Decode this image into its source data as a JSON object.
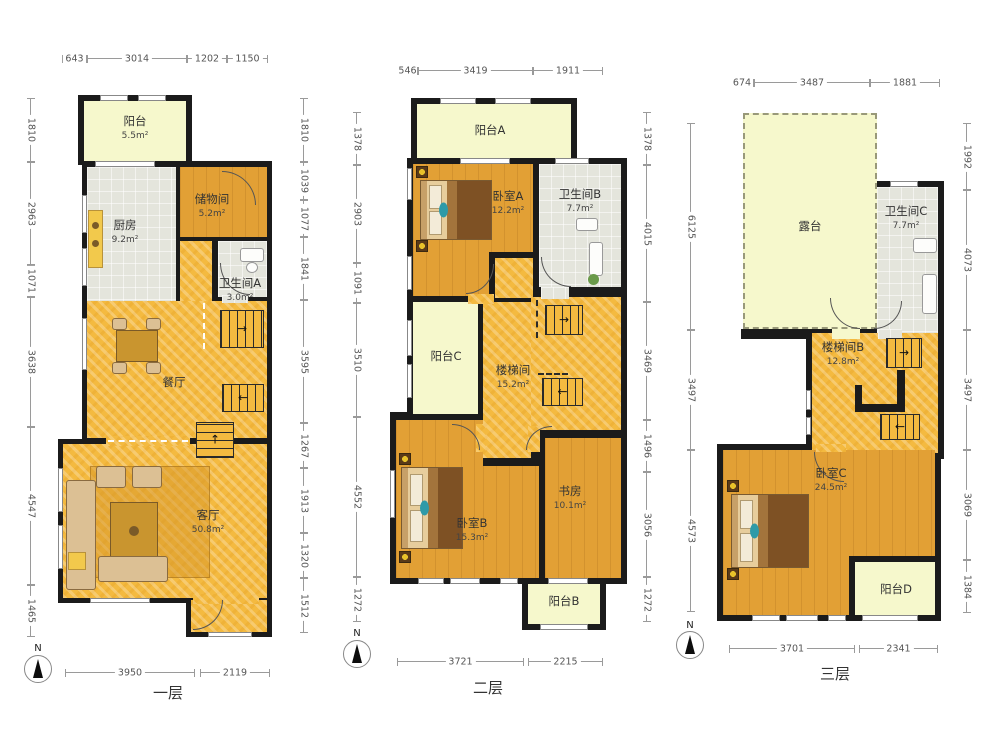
{
  "compass": {
    "letter": "N"
  },
  "icons": {
    "arrow_right": "→",
    "arrow_left": "←",
    "arrow_up": "↑"
  },
  "colors": {
    "wall": "#1b1b1b",
    "balcony": "#f6f8cc",
    "tile": "#e4e5dc",
    "wood": "#e2a035",
    "golden": "#f4ba40"
  },
  "floors": [
    {
      "label": "一层",
      "dims_top": [
        "643",
        "3014",
        "1202",
        "1150"
      ],
      "dims_bottom": [
        "3950",
        "2119"
      ],
      "dims_left": [
        "1810",
        "2963",
        "1071",
        "3638",
        "4547",
        "1465"
      ],
      "dims_right": [
        "1810",
        "1039",
        "1077",
        "1841",
        "3595",
        "1267",
        "1913",
        "1320",
        "1512"
      ],
      "rooms": {
        "balcony": {
          "name": "阳台",
          "area": "5.5m²"
        },
        "kitchen": {
          "name": "厨房",
          "area": "9.2m²"
        },
        "storage": {
          "name": "储物间",
          "area": "5.2m²"
        },
        "bath_a": {
          "name": "卫生间A",
          "area": "3.0m²"
        },
        "dining": {
          "name": "餐厅",
          "area": ""
        },
        "living": {
          "name": "客厅",
          "area": "50.8m²"
        }
      }
    },
    {
      "label": "二层",
      "dims_top": [
        "546",
        "3419",
        "1911"
      ],
      "dims_bottom": [
        "3721",
        "2215"
      ],
      "dims_left": [
        "1378",
        "2903",
        "1091",
        "3510",
        "4552",
        "1272"
      ],
      "dims_right": [
        "1378",
        "4015",
        "3469",
        "1496",
        "3056",
        "1272"
      ],
      "rooms": {
        "balcony_a": {
          "name": "阳台A",
          "area": ""
        },
        "bedroom_a": {
          "name": "卧室A",
          "area": "12.2m²"
        },
        "bath_b": {
          "name": "卫生间B",
          "area": "7.7m²"
        },
        "balcony_c": {
          "name": "阳台C",
          "area": ""
        },
        "stairwell": {
          "name": "楼梯间",
          "area": "15.2m²"
        },
        "bedroom_b": {
          "name": "卧室B",
          "area": "15.3m²"
        },
        "study": {
          "name": "书房",
          "area": "10.1m²"
        },
        "balcony_b": {
          "name": "阳台B",
          "area": ""
        }
      }
    },
    {
      "label": "三层",
      "dims_top": [
        "674",
        "3487",
        "1881"
      ],
      "dims_bottom": [
        "3701",
        "2341"
      ],
      "dims_left": [
        "6125",
        "3497",
        "4573"
      ],
      "dims_right": [
        "1992",
        "4073",
        "3497",
        "3069",
        "1384"
      ],
      "rooms": {
        "terrace": {
          "name": "露台",
          "area": ""
        },
        "bath_c": {
          "name": "卫生间C",
          "area": "7.7m²"
        },
        "stairwell_b": {
          "name": "楼梯间B",
          "area": "12.8m²"
        },
        "bedroom_c": {
          "name": "卧室C",
          "area": "24.5m²"
        },
        "balcony_d": {
          "name": "阳台D",
          "area": ""
        }
      }
    }
  ]
}
